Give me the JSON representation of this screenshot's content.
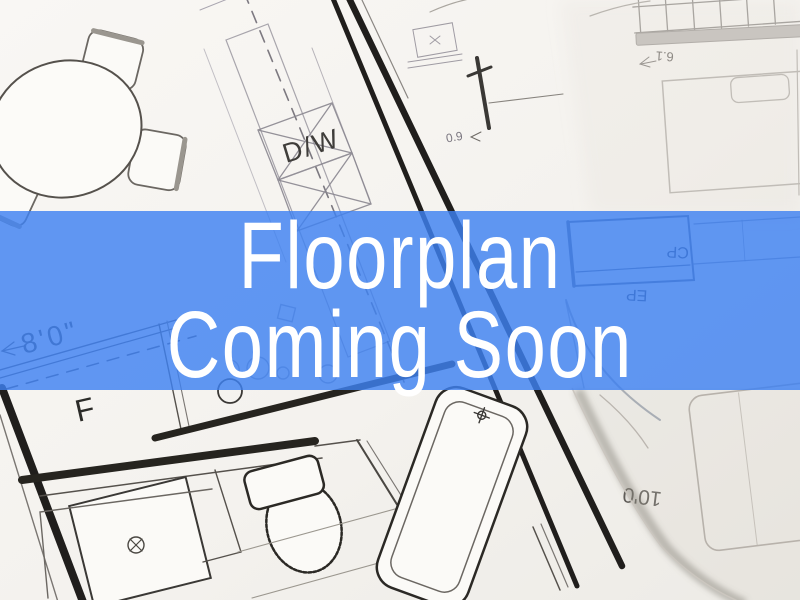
{
  "banner": {
    "line1": "Floorplan",
    "line2": "Coming Soon",
    "background_color": "#3e81f1",
    "overlay_opacity": 0.82,
    "text_color": "#ffffff"
  },
  "floorplan": {
    "paper_color": "#f5f3ef",
    "line_color": "#1f1d1b",
    "labels": {
      "dishwasher": "D/W",
      "dim_left": "8'0\"",
      "fridge": "F",
      "cp": "CP",
      "ep": "EP",
      "dim_bottom_right": "10'0",
      "dim_top_right": "6.1",
      "dim_mid": "0.9"
    }
  }
}
